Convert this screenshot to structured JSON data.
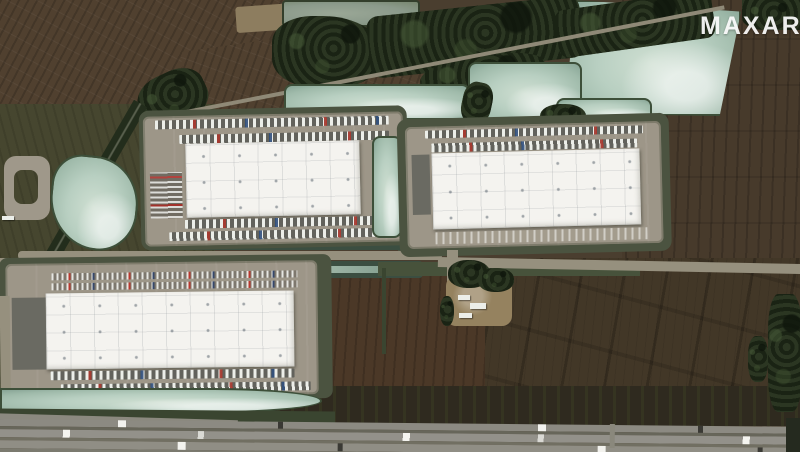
{
  "watermark": {
    "text": "MAXAR"
  },
  "scene": {
    "type": "satellite-photo",
    "subject": "Aerial view of three large white-roofed warehouse distribution buildings surrounded by retention ponds, brown farm fields, tree lines and a divided highway",
    "features": [
      {
        "name": "warehouse-northwest",
        "desc": "white flat-roof warehouse with trailer docks on north and south sides and car lot on west"
      },
      {
        "name": "warehouse-northeast",
        "desc": "white flat-roof warehouse with trailer row on north side and parking on south side"
      },
      {
        "name": "warehouse-south",
        "desc": "widest white flat-roof warehouse with car parking rows north, trailer docks south and west"
      },
      {
        "name": "retention-ponds",
        "desc": "pale seafoam-green retention ponds with dark vegetated rims"
      },
      {
        "name": "tree-line",
        "desc": "dense dark green woodland flanking a diagonal road across the top"
      },
      {
        "name": "farm-fields",
        "desc": "plowed brown fields with tillage striations"
      },
      {
        "name": "farmstead",
        "desc": "small cluster of light buildings and trees between the warehouses and fields"
      },
      {
        "name": "highway",
        "desc": "multi-lane divided highway with sparse truck traffic along the bottom edge"
      }
    ]
  },
  "palette": {
    "field_brown": "#50402f",
    "field_dark": "#423727",
    "trees_green": "#232d1c",
    "pond_pale": "#b8cfc1",
    "pond_rim": "#3d4f39",
    "pavement": "#9d9688",
    "roof_white": "#f4f3ef",
    "highway_gray": "#8c8a82",
    "watermark_white": "#ffffff"
  }
}
